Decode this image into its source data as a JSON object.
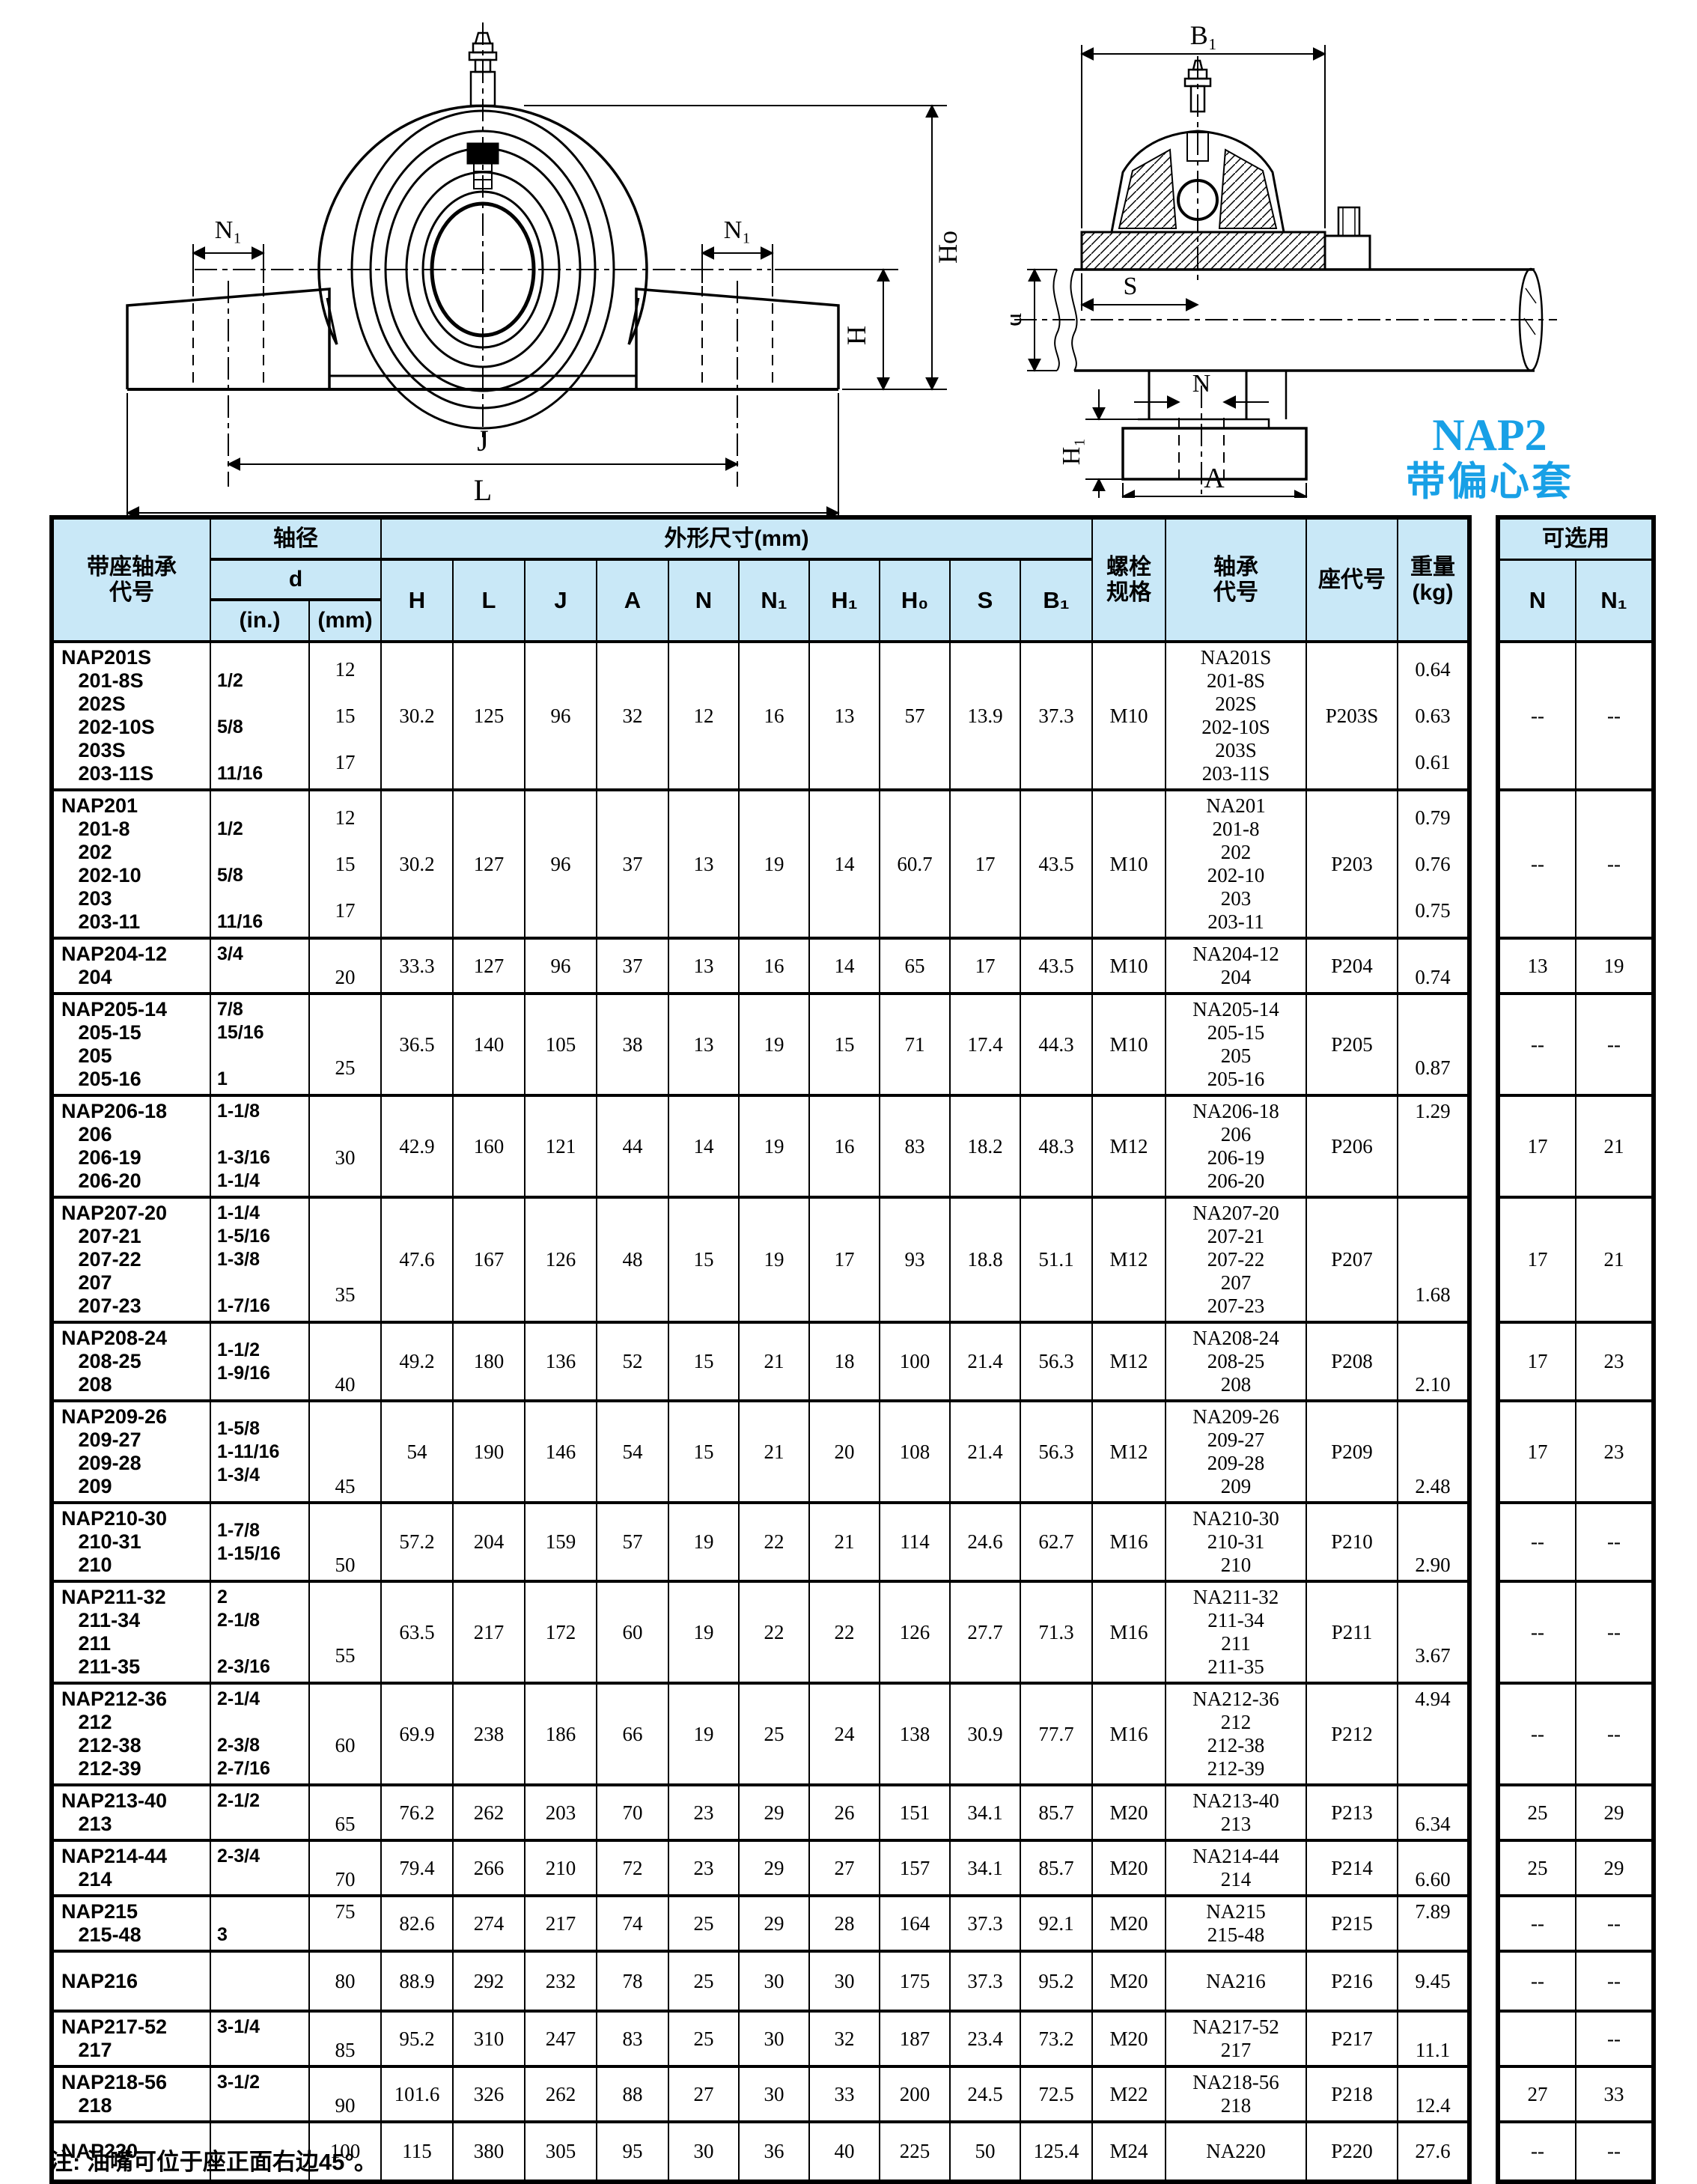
{
  "page": {
    "note": "注:  油嘴可位于座正面右边45°。",
    "series_label": "NAP2",
    "series_sublabel": "带偏心套",
    "accent_blue": "#18a0e6",
    "header_bg": "#c9e8f7"
  },
  "drawings": {
    "left": {
      "n1_left": "N₁",
      "n1_right": "N₁",
      "h": "H",
      "h0": "Ho",
      "j": "J",
      "l": "L"
    },
    "right": {
      "b1": "B₁",
      "s": "S",
      "d": "d",
      "n": "N",
      "h1": "H₁",
      "a": "A"
    }
  },
  "table": {
    "header": {
      "col_code": "带座轴承\n代号",
      "col_shaft_dia": "轴径",
      "col_d": "d",
      "col_in": "(in.)",
      "col_mm": "(mm)",
      "col_dims_group": "外形尺寸(mm)",
      "dims": [
        "H",
        "L",
        "J",
        "A",
        "N",
        "N₁",
        "H₁",
        "H₀",
        "S",
        "B₁"
      ],
      "col_bolt": "螺栓\n规格",
      "col_bearing": "轴承\n代号",
      "col_seat": "座代号",
      "col_weight": "重量\n(kg)",
      "col_optional": "可选用",
      "opt_n": "N",
      "opt_n1": "N₁"
    },
    "rows": [
      {
        "code": "NAP201S\n   201-8S\n   202S\n   202-10S\n   203S\n   203-11S",
        "d_in": "\n1/2\n\n5/8\n\n11/16",
        "d_mm": "12\n\n15\n\n17",
        "H": "30.2",
        "L": "125",
        "J": "96",
        "A": "32",
        "N": "12",
        "N1": "16",
        "H1": "13",
        "H0": "57",
        "S": "13.9",
        "B1": "37.3",
        "bolt": "M10",
        "bearing": "NA201S\n201-8S\n202S\n202-10S\n203S\n203-11S",
        "seat": "P203S",
        "weight": "0.64\n\n0.63\n\n0.61",
        "opt_n": "--",
        "opt_n1": "--"
      },
      {
        "code": "NAP201\n   201-8\n   202\n   202-10\n   203\n   203-11",
        "d_in": "\n1/2\n\n5/8\n\n11/16",
        "d_mm": "12\n\n15\n\n17",
        "H": "30.2",
        "L": "127",
        "J": "96",
        "A": "37",
        "N": "13",
        "N1": "19",
        "H1": "14",
        "H0": "60.7",
        "S": "17",
        "B1": "43.5",
        "bolt": "M10",
        "bearing": "NA201\n201-8\n202\n202-10\n203\n203-11",
        "seat": "P203",
        "weight": "0.79\n\n0.76\n\n0.75",
        "opt_n": "--",
        "opt_n1": "--"
      },
      {
        "code": "NAP204-12\n   204",
        "d_in": "3/4\n ",
        "d_mm": "\n20",
        "H": "33.3",
        "L": "127",
        "J": "96",
        "A": "37",
        "N": "13",
        "N1": "16",
        "H1": "14",
        "H0": "65",
        "S": "17",
        "B1": "43.5",
        "bolt": "M10",
        "bearing": "NA204-12\n204",
        "seat": "P204",
        "weight": "\n0.74",
        "opt_n": "13",
        "opt_n1": "19"
      },
      {
        "code": "NAP205-14\n   205-15\n   205\n   205-16",
        "d_in": "7/8\n15/16\n\n1",
        "d_mm": "\n\n25",
        "H": "36.5",
        "L": "140",
        "J": "105",
        "A": "38",
        "N": "13",
        "N1": "19",
        "H1": "15",
        "H0": "71",
        "S": "17.4",
        "B1": "44.3",
        "bolt": "M10",
        "bearing": "NA205-14\n205-15\n205\n205-16",
        "seat": "P205",
        "weight": "\n\n0.87",
        "opt_n": "--",
        "opt_n1": "--"
      },
      {
        "code": "NAP206-18\n   206\n   206-19\n   206-20",
        "d_in": "1-1/8\n\n1-3/16\n1-1/4",
        "d_mm": "\n30",
        "H": "42.9",
        "L": "160",
        "J": "121",
        "A": "44",
        "N": "14",
        "N1": "19",
        "H1": "16",
        "H0": "83",
        "S": "18.2",
        "B1": "48.3",
        "bolt": "M12",
        "bearing": "NA206-18\n206\n206-19\n206-20",
        "seat": "P206",
        "weight": "1.29\n \n \n ",
        "opt_n": "17",
        "opt_n1": "21"
      },
      {
        "code": "NAP207-20\n   207-21\n   207-22\n   207\n   207-23",
        "d_in": "1-1/4\n1-5/16\n1-3/8\n\n1-7/16",
        "d_mm": "\n\n\n35",
        "H": "47.6",
        "L": "167",
        "J": "126",
        "A": "48",
        "N": "15",
        "N1": "19",
        "H1": "17",
        "H0": "93",
        "S": "18.8",
        "B1": "51.1",
        "bolt": "M12",
        "bearing": "NA207-20\n207-21\n207-22\n207\n207-23",
        "seat": "P207",
        "weight": "\n\n\n1.68",
        "opt_n": "17",
        "opt_n1": "21"
      },
      {
        "code": "NAP208-24\n   208-25\n   208",
        "d_in": "1-1/2\n1-9/16",
        "d_mm": "\n\n40",
        "H": "49.2",
        "L": "180",
        "J": "136",
        "A": "52",
        "N": "15",
        "N1": "21",
        "H1": "18",
        "H0": "100",
        "S": "21.4",
        "B1": "56.3",
        "bolt": "M12",
        "bearing": "NA208-24\n208-25\n208",
        "seat": "P208",
        "weight": "\n\n2.10",
        "opt_n": "17",
        "opt_n1": "23"
      },
      {
        "code": "NAP209-26\n   209-27\n   209-28\n   209",
        "d_in": "1-5/8\n1-11/16\n1-3/4",
        "d_mm": "\n\n\n45",
        "H": "54",
        "L": "190",
        "J": "146",
        "A": "54",
        "N": "15",
        "N1": "21",
        "H1": "20",
        "H0": "108",
        "S": "21.4",
        "B1": "56.3",
        "bolt": "M12",
        "bearing": "NA209-26\n209-27\n209-28\n209",
        "seat": "P209",
        "weight": "\n\n\n2.48",
        "opt_n": "17",
        "opt_n1": "23"
      },
      {
        "code": "NAP210-30\n   210-31\n   210",
        "d_in": "1-7/8\n1-15/16",
        "d_mm": "\n\n50",
        "H": "57.2",
        "L": "204",
        "J": "159",
        "A": "57",
        "N": "19",
        "N1": "22",
        "H1": "21",
        "H0": "114",
        "S": "24.6",
        "B1": "62.7",
        "bolt": "M16",
        "bearing": "NA210-30\n210-31\n210",
        "seat": "P210",
        "weight": "\n\n2.90",
        "opt_n": "--",
        "opt_n1": "--"
      },
      {
        "code": "NAP211-32\n   211-34\n   211\n   211-35",
        "d_in": "2\n2-1/8\n\n2-3/16",
        "d_mm": "\n\n55",
        "H": "63.5",
        "L": "217",
        "J": "172",
        "A": "60",
        "N": "19",
        "N1": "22",
        "H1": "22",
        "H0": "126",
        "S": "27.7",
        "B1": "71.3",
        "bolt": "M16",
        "bearing": "NA211-32\n211-34\n211\n211-35",
        "seat": "P211",
        "weight": "\n\n3.67",
        "opt_n": "--",
        "opt_n1": "--"
      },
      {
        "code": "NAP212-36\n   212\n   212-38\n   212-39",
        "d_in": "2-1/4\n\n2-3/8\n2-7/16",
        "d_mm": "\n60",
        "H": "69.9",
        "L": "238",
        "J": "186",
        "A": "66",
        "N": "19",
        "N1": "25",
        "H1": "24",
        "H0": "138",
        "S": "30.9",
        "B1": "77.7",
        "bolt": "M16",
        "bearing": "NA212-36\n212\n212-38\n212-39",
        "seat": "P212",
        "weight": "4.94\n \n \n ",
        "opt_n": "--",
        "opt_n1": "--"
      },
      {
        "code": "NAP213-40\n   213",
        "d_in": "2-1/2\n ",
        "d_mm": "\n65",
        "H": "76.2",
        "L": "262",
        "J": "203",
        "A": "70",
        "N": "23",
        "N1": "29",
        "H1": "26",
        "H0": "151",
        "S": "34.1",
        "B1": "85.7",
        "bolt": "M20",
        "bearing": "NA213-40\n213",
        "seat": "P213",
        "weight": "\n6.34",
        "opt_n": "25",
        "opt_n1": "29"
      },
      {
        "code": "NAP214-44\n   214",
        "d_in": "2-3/4\n ",
        "d_mm": "\n70",
        "H": "79.4",
        "L": "266",
        "J": "210",
        "A": "72",
        "N": "23",
        "N1": "29",
        "H1": "27",
        "H0": "157",
        "S": "34.1",
        "B1": "85.7",
        "bolt": "M20",
        "bearing": "NA214-44\n214",
        "seat": "P214",
        "weight": "\n6.60",
        "opt_n": "25",
        "opt_n1": "29"
      },
      {
        "code": "NAP215\n   215-48",
        "d_in": "\n3",
        "d_mm": "75\n ",
        "H": "82.6",
        "L": "274",
        "J": "217",
        "A": "74",
        "N": "25",
        "N1": "29",
        "H1": "28",
        "H0": "164",
        "S": "37.3",
        "B1": "92.1",
        "bolt": "M20",
        "bearing": "NA215\n215-48",
        "seat": "P215",
        "weight": "7.89\n ",
        "opt_n": "--",
        "opt_n1": "--"
      },
      {
        "code": "NAP216",
        "d_in": "",
        "d_mm": "80",
        "H": "88.9",
        "L": "292",
        "J": "232",
        "A": "78",
        "N": "25",
        "N1": "30",
        "H1": "30",
        "H0": "175",
        "S": "37.3",
        "B1": "95.2",
        "bolt": "M20",
        "bearing": "NA216",
        "seat": "P216",
        "weight": "9.45",
        "opt_n": "--",
        "opt_n1": "--"
      },
      {
        "code": "NAP217-52\n   217",
        "d_in": "3-1/4\n ",
        "d_mm": "\n85",
        "H": "95.2",
        "L": "310",
        "J": "247",
        "A": "83",
        "N": "25",
        "N1": "30",
        "H1": "32",
        "H0": "187",
        "S": "23.4",
        "B1": "73.2",
        "bolt": "M20",
        "bearing": "NA217-52\n217",
        "seat": "P217",
        "weight": "\n11.1",
        "opt_n": "",
        "opt_n1": "--"
      },
      {
        "code": "NAP218-56\n   218",
        "d_in": "3-1/2\n ",
        "d_mm": "\n90",
        "H": "101.6",
        "L": "326",
        "J": "262",
        "A": "88",
        "N": "27",
        "N1": "30",
        "H1": "33",
        "H0": "200",
        "S": "24.5",
        "B1": "72.5",
        "bolt": "M22",
        "bearing": "NA218-56\n218",
        "seat": "P218",
        "weight": "\n12.4",
        "opt_n": "27",
        "opt_n1": "33"
      },
      {
        "code": "NAP220",
        "d_in": "",
        "d_mm": "100",
        "H": "115",
        "L": "380",
        "J": "305",
        "A": "95",
        "N": "30",
        "N1": "36",
        "H1": "40",
        "H0": "225",
        "S": "50",
        "B1": "125.4",
        "bolt": "M24",
        "bearing": "NA220",
        "seat": "P220",
        "weight": "27.6",
        "opt_n": "--",
        "opt_n1": "--"
      }
    ]
  }
}
